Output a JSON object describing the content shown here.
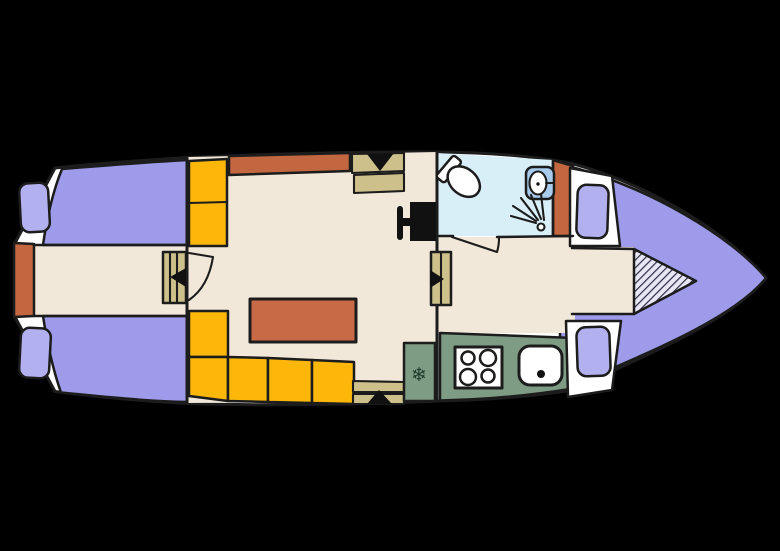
{
  "palette": {
    "background": "#000000",
    "outline": "#1c1c1c",
    "hull_white": "#ffffff",
    "floor_cream": "#f2e8da",
    "bed_purple": "#9e9bea",
    "pillow_purple": "#b3b0ef",
    "accent_orange": "#c2673f",
    "table_orange": "#c76a45",
    "seat_yellow": "#fcb70a",
    "wood_tan": "#cdc08b",
    "kitchen_green": "#7e9b84",
    "bathroom_blue": "#d9eff8",
    "sink_blue": "#a9cbec",
    "fixture_white": "#ffffff",
    "hatch_bg": "#e9e7f5",
    "hatch_line": "#2c2c45",
    "arrow_black": "#111111",
    "snowflake_green": "#1e3a29"
  },
  "icons": {
    "snowflake_glyph": "❄"
  }
}
